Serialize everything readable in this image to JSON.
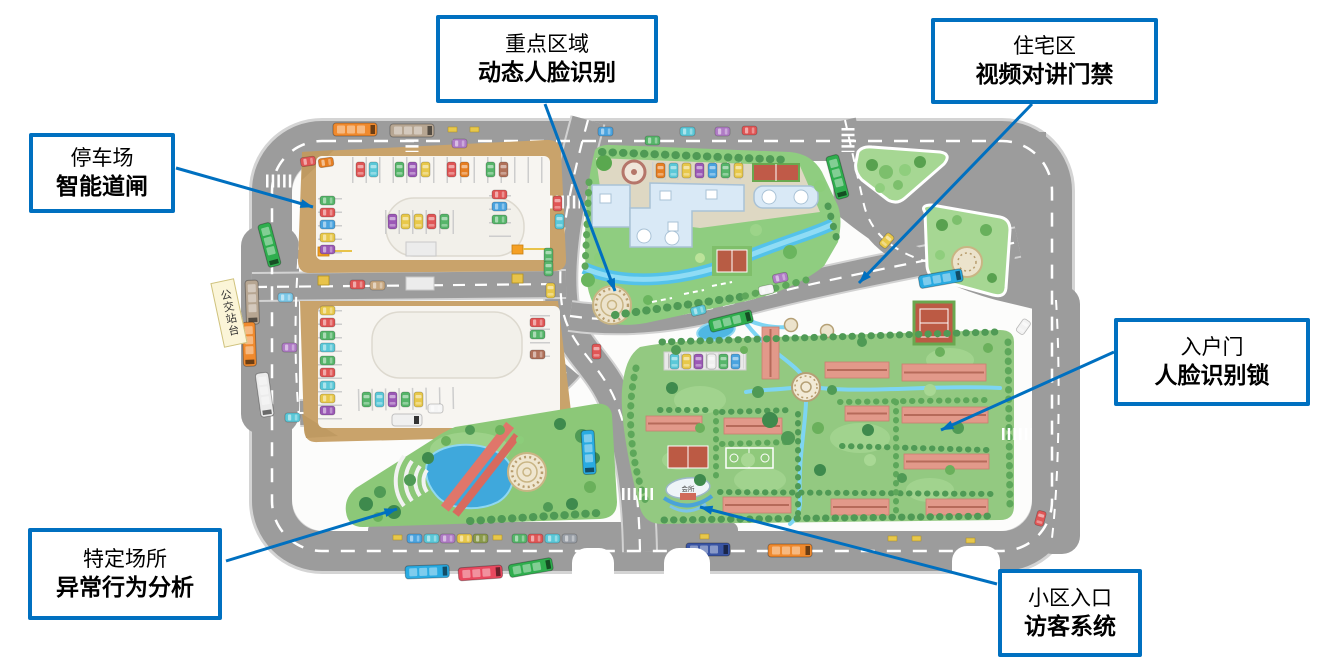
{
  "callouts": [
    {
      "id": "parking-lot",
      "line1": "停车场",
      "line2": "智能道闸"
    },
    {
      "id": "key-area",
      "line1": "重点区域",
      "line2": "动态人脸识别"
    },
    {
      "id": "residential-area",
      "line1": "住宅区",
      "line2": "视频对讲门禁"
    },
    {
      "id": "entry-door",
      "line1": "入户门",
      "line2": "人脸识别锁"
    },
    {
      "id": "special-place",
      "line1": "特定场所",
      "line2": "异常行为分析"
    },
    {
      "id": "community-entrance",
      "line1": "小区入口",
      "line2": "访客系统"
    }
  ],
  "map": {
    "bus_stop_label": "公交站台",
    "gate_label": "会所"
  },
  "colors": {
    "callout_border": "#0070c0",
    "arrow": "#0070c0",
    "road": "#9c9c9c",
    "lawn": "#8fcd80",
    "water": "#54c2ea",
    "residential_roof": "#e2998a",
    "parking_tan": "#c9a36b"
  }
}
